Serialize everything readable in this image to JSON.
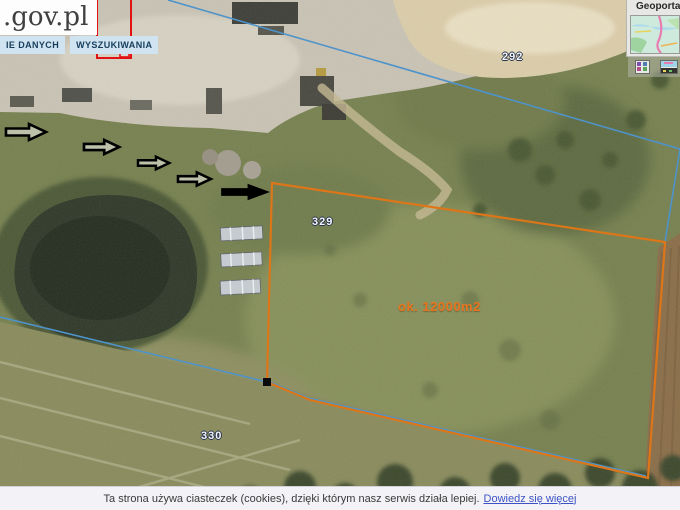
{
  "header": {
    "brand": ".gov.pl",
    "menu_tabs": [
      {
        "label": "IE DANYCH"
      },
      {
        "label": "WYSZUKIWANIA"
      }
    ]
  },
  "overview_panel": {
    "title": "Geoportal"
  },
  "toolbar": {
    "icons": [
      {
        "name": "legend-icon"
      },
      {
        "name": "overview-map-icon"
      }
    ]
  },
  "map": {
    "parcel_labels": [
      {
        "text": "292"
      },
      {
        "text": "329"
      },
      {
        "text": "330"
      }
    ],
    "area_annotation": "ok. 12000m2",
    "annotation_colors": {
      "measured_parcel_outline": "#dd7618",
      "cadastral_boundary": "#4e93c9",
      "selection_rectangle": "#e31212",
      "direction_arrows": "#000000"
    }
  },
  "cookie_banner": {
    "message": "Ta strona używa ciasteczek (cookies), dzięki którym nasz serwis działa lepiej.",
    "link_label": "Dowiedz się więcej"
  }
}
